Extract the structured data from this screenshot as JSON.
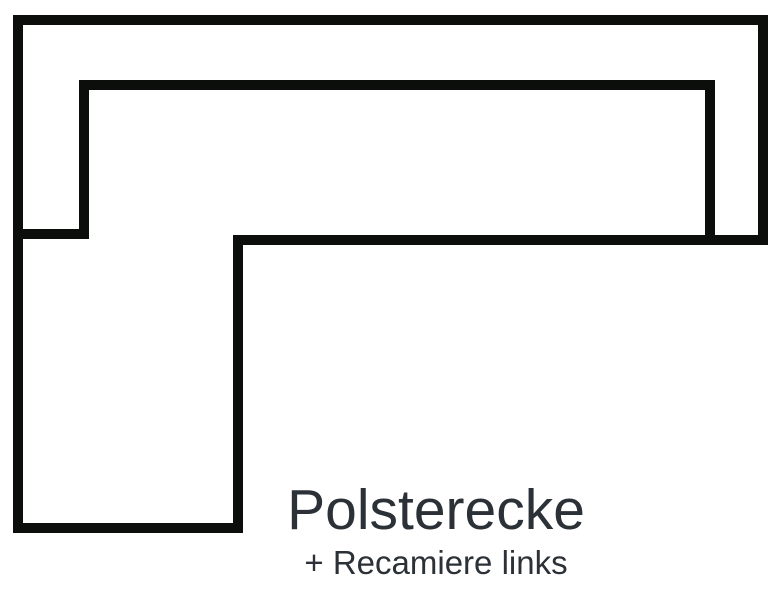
{
  "diagram": {
    "kind": "sofa-top-view-outline",
    "description_of_shape": "L-shaped corner sofa footprint, top view, chaise column on left",
    "caption": {
      "title": "Polsterecke",
      "subtitle": "+ Recamiere links"
    },
    "colors": {
      "background": "#ffffff",
      "outline": "#0c0e0c",
      "caption_text": "#2b3136"
    },
    "outline": {
      "stroke_width": 10,
      "outer_path": "M18 20 H763 V240 H238 V528 H18 Z",
      "backrest_path": "M13 234 H84 V85 H710 V240"
    }
  }
}
